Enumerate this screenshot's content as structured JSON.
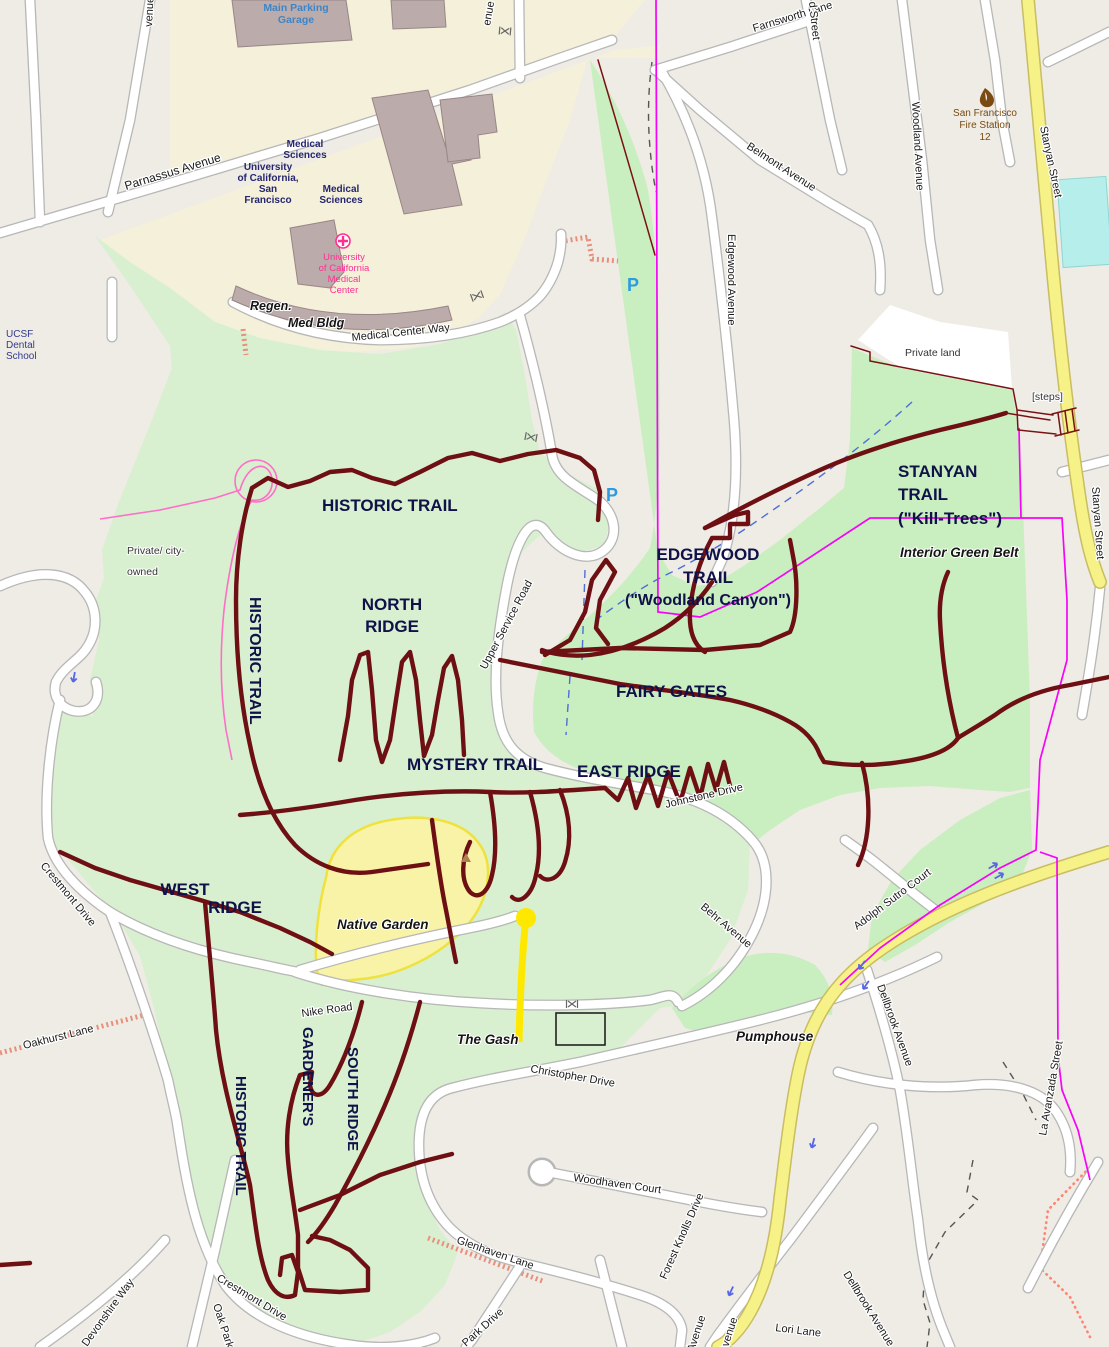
{
  "map_type": "OpenStreetMap-style trail map with overlaid trail annotations",
  "colors": {
    "base_urban": "#eeece4",
    "campus_beige": "#f4f0da",
    "forest_green": "#d8f0d0",
    "greenbelt_green": "#c9eec0",
    "native_garden_fill": "#f8f3a6",
    "native_garden_edge": "#efe23e",
    "road_fill": "#ffffff",
    "road_casing": "#b7b7b7",
    "secondary_road_yellow": "#f6f288",
    "trail_maroon": "#6e1013",
    "boundary_magenta": "#f703f7",
    "boundary_pink": "#ff6ec7",
    "stream_blue": "#4d6fd6",
    "gash_yellow": "#ffe800",
    "water_cyan": "#b5eeea",
    "building_mauve": "#bcabab",
    "trail_label_navy": "#0f1148",
    "parking_blue": "#2e9ae0",
    "hospital_magenta": "#ff2f92",
    "fire_brown": "#7a4a12"
  },
  "icons": {
    "parking": "P",
    "hospital": "cross-in-circle",
    "fire_station": "flame",
    "peak": "small-triangle",
    "gate": "crossed-bars",
    "steps": "ladder-hatching",
    "one_way": "blue-arrow"
  },
  "labels": {
    "main_parking_garage": [
      "Main Parking",
      "Garage"
    ],
    "parnassus_avenue": "Parnassus Avenue",
    "medical_sciences_a": [
      "Medical",
      "Sciences"
    ],
    "medical_sciences_b": [
      "Medical",
      "Sciences"
    ],
    "ucsf_name": [
      "University",
      "of California,",
      "San",
      "Francisco"
    ],
    "ucsf_medical_center": [
      "University",
      "of California",
      "Medical",
      "Center"
    ],
    "ucsf_dental_school": [
      "UCSF",
      "Dental",
      "School"
    ],
    "regen": "Regen.",
    "med_bldg": "Med Bldg",
    "medical_center_way": "Medical Center Way",
    "farnsworth_lane": "Farnsworth Lane",
    "willard_street_fragment": "d Street",
    "belmont_avenue": "Belmont Avenue",
    "woodland_avenue": "Woodland Avenue",
    "edgewood_avenue": "Edgewood Avenue",
    "fire_station_12": [
      "San Francisco",
      "Fire Station",
      "12"
    ],
    "stanyan_street_north": "Stanyan Street",
    "stanyan_street_east": "Stanyan Street",
    "private_land": "Private land",
    "steps": "[steps]",
    "private_city_owned": [
      "Private/ city-",
      "owned"
    ],
    "historic_trail_north": "HISTORIC TRAIL",
    "historic_trail_west": "HISTORIC TRAIL",
    "historic_trail_south": "HISTORIC TRAIL",
    "north_ridge": [
      "NORTH",
      "RIDGE"
    ],
    "upper_service_road": "Upper Service Road",
    "edgewood_trail": [
      "EDGEWOOD",
      "TRAIL",
      "(\"Woodland Canyon\")"
    ],
    "stanyan_trail": [
      "STANYAN",
      "TRAIL",
      "(\"Kill-Trees\")"
    ],
    "interior_green_belt": "Interior Green Belt",
    "fairy_gates": "FAIRY GATES",
    "mystery_trail": "MYSTERY TRAIL",
    "east_ridge": "EAST RIDGE",
    "johnstone_drive": "Johnstone Drive",
    "west_ridge": [
      "WEST",
      "RIDGE"
    ],
    "native_garden": "Native Garden",
    "crestmont_drive_north": "Crestmont Drive",
    "crestmont_drive_south": "Crestmont Drive",
    "oakhurst_lane": "Oakhurst Lane",
    "nike_road": "Nike Road",
    "gardeners": "GARDENER'S",
    "south_ridge": "SOUTH RIDGE",
    "the_gash": "The Gash",
    "pumphouse": "Pumphouse",
    "christopher_drive": "Christopher Drive",
    "behr_avenue": "Behr Avenue",
    "adolph_sutro_court": "Adolph Sutro Court",
    "dellbrook_avenue_east": "Dellbrook Avenue",
    "dellbrook_avenue_south": "Dellbrook Avenue",
    "la_avanzada_street": "La Avanzada Street",
    "woodhaven_court": "Woodhaven Court",
    "glenhaven_lane": "Glenhaven Lane",
    "forest_knolls_drive": "Forest Knolls Drive",
    "park_drive": "Park Drive",
    "oak_park_drive": "Oak Park",
    "devonshire_way": "Devonshire Way",
    "lori_lane": "Lori Lane",
    "clarendon_avenue_fragment_a": "Avenue",
    "clarendon_avenue_fragment_b": "Avenue",
    "avenue_fragment_nw": "venue",
    "avenue_fragment_n": "enue",
    "parking_p_north": "P",
    "parking_p_south": "P"
  }
}
